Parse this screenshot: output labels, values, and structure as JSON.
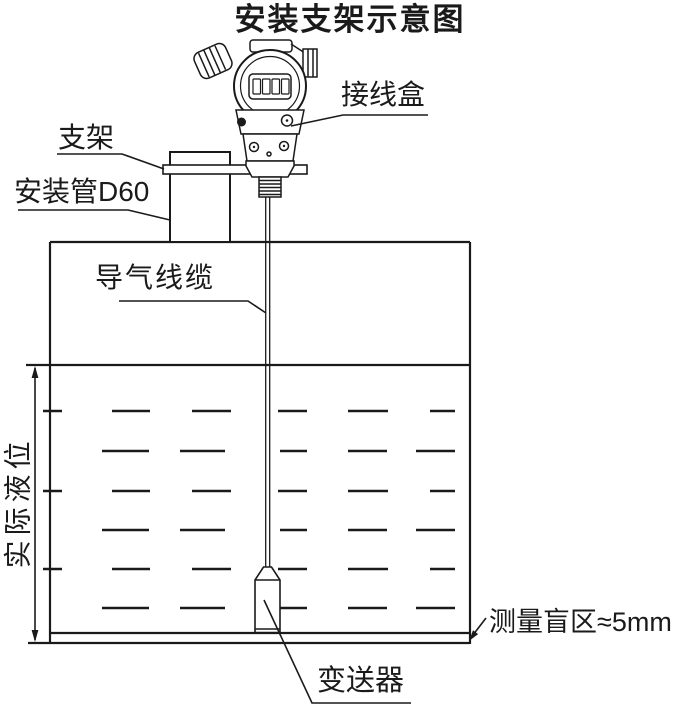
{
  "title": "安装支架示意图",
  "colors": {
    "line": "#1a1a1a",
    "background": "#ffffff"
  },
  "labels": {
    "bracket": "支架",
    "mounting_pipe": "安装管D60",
    "junction_box": "接线盒",
    "air_cable": "导气线缆",
    "actual_level": "实际液位",
    "blind_zone": "测量盲区≈5mm",
    "transmitter": "变送器"
  },
  "display": {
    "digit_cells": 4
  }
}
